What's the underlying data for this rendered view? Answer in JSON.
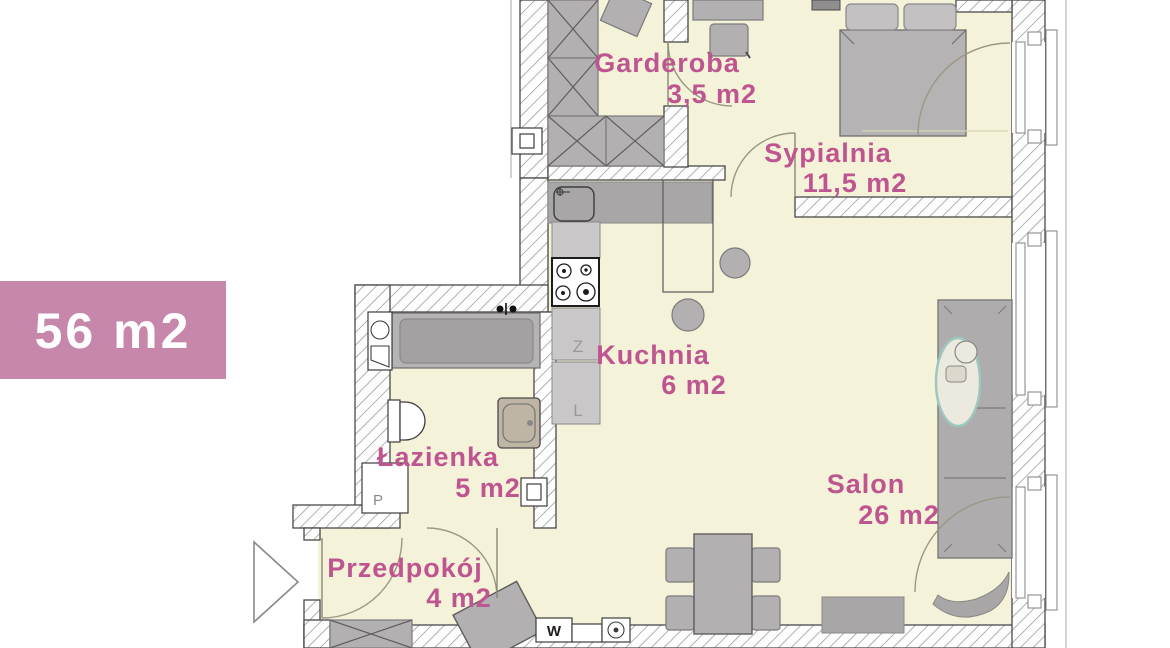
{
  "badge": {
    "area_label": "56 m2"
  },
  "rooms": [
    {
      "id": "garderoba",
      "name": "Garderoba",
      "area": "3,5 m2"
    },
    {
      "id": "sypialnia",
      "name": "Sypialnia",
      "area": "11,5 m2"
    },
    {
      "id": "kuchnia",
      "name": "Kuchnia",
      "area": "6 m2"
    },
    {
      "id": "lazienka",
      "name": "Łazienka",
      "area": "5 m2"
    },
    {
      "id": "przedpokoj",
      "name": "Przedpokój",
      "area": "4 m2"
    },
    {
      "id": "salon",
      "name": "Salon",
      "area": "26 m2"
    }
  ],
  "fixture_labels": {
    "dishwasher": "Z",
    "fridge": "L",
    "washing_machine": "P",
    "heater": "W"
  },
  "colors": {
    "badge_bg": "#c687ab",
    "label_pink": "#bf5590",
    "floor": "#f4f2d8",
    "furniture_gray": "#b2b0b1",
    "wall_line": "#4a4a4a"
  }
}
